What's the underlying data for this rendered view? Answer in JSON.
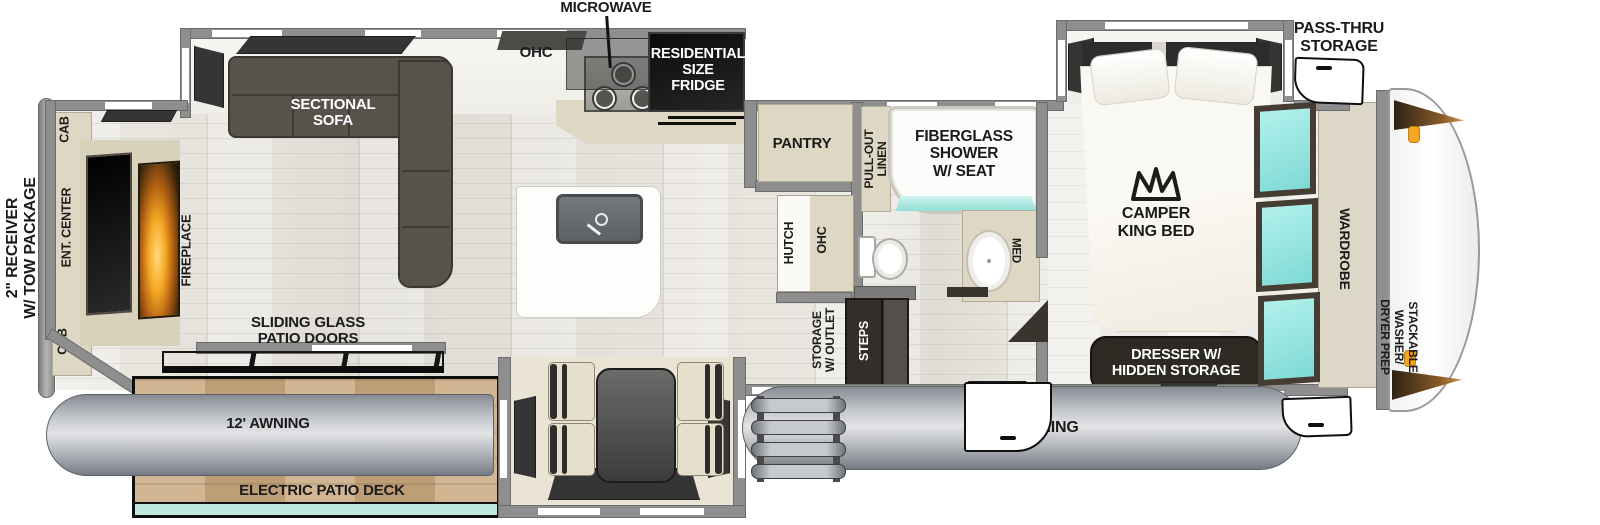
{
  "floorplan": {
    "exterior": {
      "receiver": "2\" RECEIVER\nW/ TOW PACKAGE",
      "pass_thru": "PASS-THRU\nSTORAGE",
      "awning_rear": "12' AWNING",
      "awning_main": "16' AWNING",
      "patio_deck": "ELECTRIC PATIO DECK"
    },
    "living": {
      "sofa": "SECTIONAL\nSOFA",
      "cab_top": "CAB",
      "cab_bottom": "CAB",
      "ent_center": "ENT. CENTER",
      "fireplace": "FIREPLACE",
      "ohc": "OHC",
      "patio_doors": "SLIDING GLASS\nPATIO DOORS"
    },
    "kitchen": {
      "microwave": "MICROWAVE",
      "fridge": "RESIDENTIAL\nSIZE\nFRIDGE",
      "pantry": "PANTRY",
      "hutch": "HUTCH",
      "hutch_ohc": "OHC",
      "storage_outlet": "STORAGE\nW/ OUTLET",
      "steps": "STEPS"
    },
    "bath": {
      "linen": "PULL-OUT\nLINEN",
      "shower": "FIBERGLASS\nSHOWER\nW/ SEAT",
      "med": "MED"
    },
    "bedroom": {
      "bed": "CAMPER\nKING BED",
      "dresser": "DRESSER W/\nHIDDEN STORAGE",
      "wardrobe": "WARDROBE",
      "washer": "STACKABLE\nWASHER/\nDRYER PREP"
    },
    "colors": {
      "wall": "#8e8e8e",
      "window_teal": "#8fe8e4",
      "furniture_dark": "#57534b",
      "cabinet_beige": "#ddd7c3",
      "fireplace_glow": "#f59a1d",
      "deck_wood": "#c8a67c",
      "awning_gray": "#b9bdc2",
      "label_dark": "#1b1b1b"
    }
  }
}
